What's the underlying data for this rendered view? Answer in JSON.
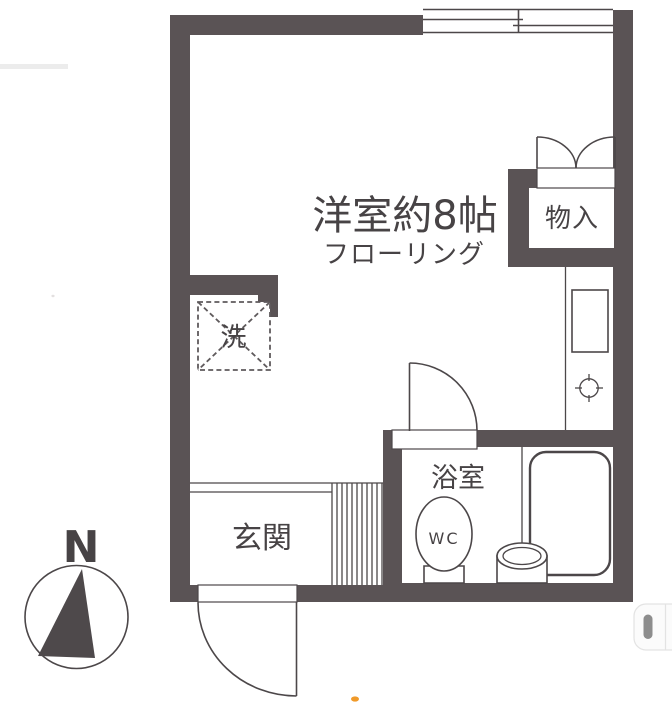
{
  "labels": {
    "main_room": "洋室約8帖",
    "main_room_sub": "フローリング",
    "closet": "物入",
    "washer": "洗",
    "entrance": "玄関",
    "bathroom": "浴室",
    "toilet": "WC",
    "compass_north": "N"
  },
  "colors": {
    "bg": "#ffffff",
    "wall": "#5a5355",
    "line": "#4c4749",
    "stripe": "#5f5a5c",
    "text": "#474345",
    "widget-bg": "#fbfbfb",
    "widget-border": "#e3e3e3",
    "widget-bar": "#8d8d8d",
    "artifact-orange": "#f09a2a",
    "artifact-gray": "#ececec"
  }
}
